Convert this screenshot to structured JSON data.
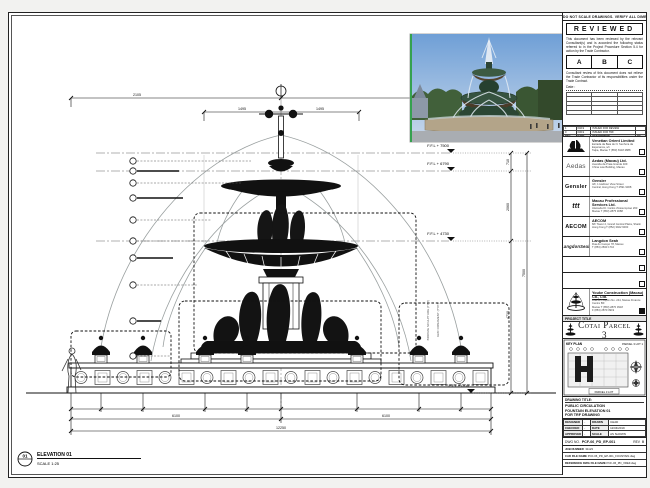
{
  "sheet": {
    "disclaimer": "DO NOT SCALE DRAWINGS. VERIFY ALL DIMENSIONS ON SITE."
  },
  "stamp": {
    "title": "REVIEWED",
    "para1": "This document has been reviewed by the relevant Consultant(s) and is accorded the following status referred to in the Project Procedure Section 5.4 for action by the Trade Contractor.",
    "statuses": [
      "A",
      "B",
      "C"
    ],
    "para2": "Consultant review of this document does not relieve the Trade Contractor of its responsibilities under the Trade Contract.",
    "date_label": "Date :"
  },
  "rev_table": {
    "headers": [
      "REV",
      "DATE",
      "DESCRIPTION",
      "BY"
    ],
    "rows": [
      [
        "1",
        "04/19",
        "ISSUED FOR REVIEW",
        ""
      ],
      [
        "0",
        "03/19",
        "ISSUED FOR TRF",
        ""
      ]
    ]
  },
  "consultants": [
    {
      "name": "Venetian Orient Limited",
      "line1": "Estrada da Baia de N. Senhora da Esperanca, s/n",
      "line2": "Taipa, Macau   T (853) 8118 2888"
    },
    {
      "name": "Aedas (Macau) Ltd.",
      "logo": "Aedas",
      "line1": "Avenida da Praia Grande 409",
      "line2": "China Law Building, Macau"
    },
    {
      "name": "Gensler",
      "logo": "Gensler",
      "line1": "4/F, 1 Harbour View Street",
      "line2": "Central, Hong Kong   T 2591 9308"
    },
    {
      "name": "Macau Professional Services Ltd.",
      "logo": "ttt",
      "line1": "Alameda Dr. Carlos d'Assumpcao 263",
      "line2": "Macau   T (853) 2875 3088"
    },
    {
      "name": "AECOM",
      "logo": "AECOM",
      "line1": "8/F Tower 2, Grand Central Plaza, Shatin",
      "line2": "Hong Kong   T (852) 3922 9000"
    },
    {
      "name": "Langdon Seah",
      "logo": "LangdonSeah",
      "line1": "Rua do Campo 78, Macau",
      "line2": "T (853) 2833 1710"
    }
  ],
  "contractor": {
    "name": "Youke Construction (Macau) Co., Ltd.",
    "line1": "Rua de Pequim No. 244, Macau Finance Centre 8/F",
    "line2": "Macau   T (853) 2870 3918",
    "line3": "F (853) 2870 3919"
  },
  "project": {
    "label": "PROJECT TITLE",
    "name": "Cotai Parcel 3"
  },
  "key_plan": {
    "label": "KEY PLAN",
    "lot": "PARCEL 3 LOT 1",
    "caption": "PARCEL 3 LOT"
  },
  "title_block": {
    "label": "DRAWING TITLE:",
    "line1": "PUBLIC CIRCULATION",
    "line2": "FOUNTAIN ELEVATION 01",
    "line3": "FOR TRF DRAWING",
    "designed_label": "DESIGNED",
    "designed": "-",
    "drawn_label": "DRAWN",
    "drawn": "CHAD",
    "checked_label": "CHECKED",
    "checked": "-",
    "date_label": "DATE",
    "date": "12/04/2019",
    "approved_label": "APPROVED",
    "approved": "-",
    "scale_label": "SCALE",
    "scale": "AS SHOWN"
  },
  "dwg": {
    "label": "DWG NO.",
    "number": "PCF-06_PD_EP-001",
    "rev_label": "REV",
    "rev": "0"
  },
  "meta": {
    "job_label": "JOB NUMBER",
    "job": "31123",
    "cad_label": "CAD FILE NAME",
    "cad": "PCF-06_PD_EP-001_FOUNTAIN.dwg",
    "ref_label": "REFERENCE DWG FILE NAME",
    "ref": "PCF-06_PD_XREF.dwg"
  },
  "drawing": {
    "bubble": "01",
    "title": "ELEVATION 01",
    "scale": "SCALE 1:25",
    "levels": [
      "F.F.L + 7500",
      "F.F.L + 6790",
      "F.F.L + 4730",
      "F.F.L ± 0.00"
    ],
    "vdims": [
      "710",
      "2060",
      "4730",
      "7500"
    ],
    "topdims": [
      "2105",
      "1495",
      "1495",
      "2105"
    ],
    "botdims": [
      "6100",
      "6100",
      "12250"
    ],
    "notes": [
      "BRONZE SCULPTURE (TYP.)",
      "GRC ORNAMENT (TYP.)"
    ]
  }
}
